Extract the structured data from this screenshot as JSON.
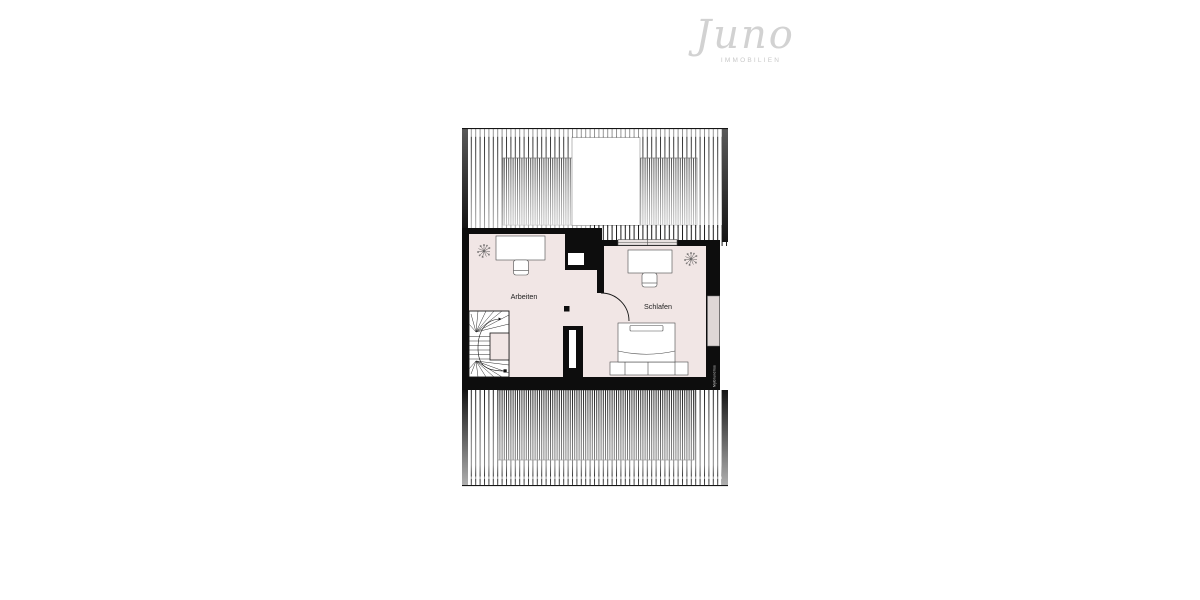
{
  "logo": {
    "brand": "Juno",
    "tagline": "IMMOBILIEN",
    "brand_color": "#d2d2d2",
    "tagline_color": "#c9c9c9"
  },
  "floorplan": {
    "rooms": {
      "work": {
        "label": "Arbeiten"
      },
      "sleep": {
        "label": "Schlafen"
      }
    },
    "watermark": "MyGrundriss",
    "colors": {
      "floor": "#f1e6e5",
      "wall": "#0d0d0d",
      "window_glass": "#e9e3e2",
      "roof_window": "#ded7d6",
      "label_text": "#222222"
    }
  }
}
